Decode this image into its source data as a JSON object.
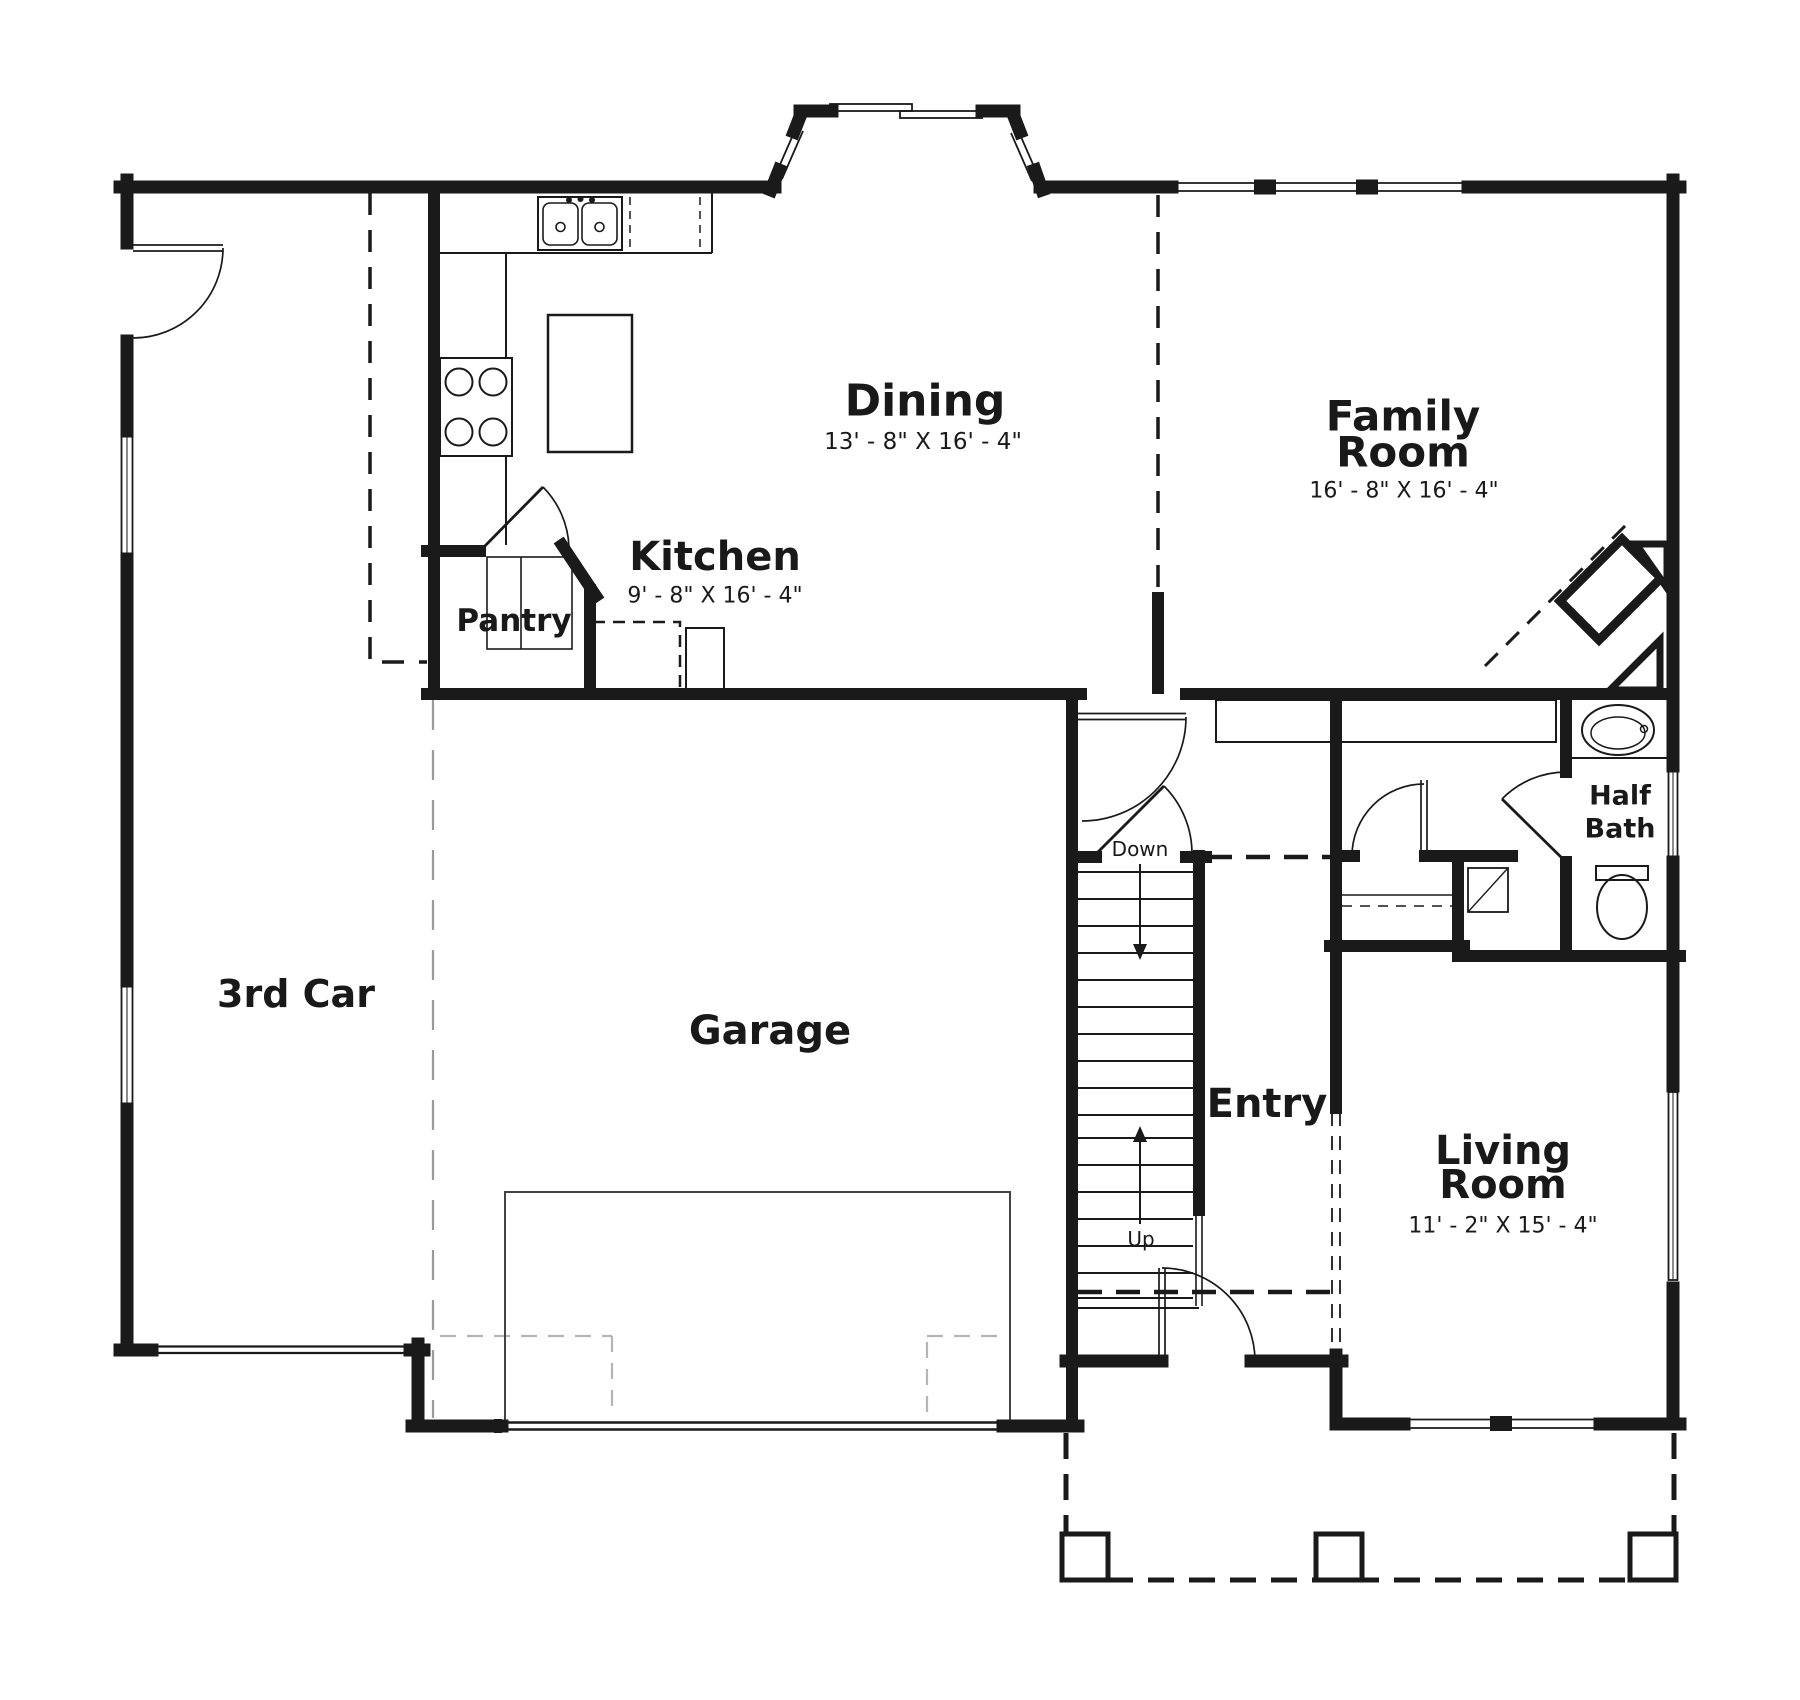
{
  "page": {
    "background": "#ffffff",
    "ink": "#1a1a1a",
    "gray_dash": "#b5b5b5"
  },
  "rooms": [
    {
      "id": "dining",
      "name": "Dining",
      "dims": "13' - 8\" X 16' - 4\""
    },
    {
      "id": "family-room",
      "name": "Family",
      "name_line2": "Room",
      "dims": "16' - 8\" X 16' - 4\""
    },
    {
      "id": "kitchen",
      "name": "Kitchen",
      "dims": "9' - 8\" X 16' - 4\""
    },
    {
      "id": "pantry",
      "name": "Pantry"
    },
    {
      "id": "half-bath",
      "name": "Half",
      "name_line2": "Bath"
    },
    {
      "id": "third-car",
      "name": "3rd Car"
    },
    {
      "id": "garage",
      "name": "Garage"
    },
    {
      "id": "entry",
      "name": "Entry"
    },
    {
      "id": "living-room",
      "name": "Living",
      "name_line2": "Room",
      "dims": "11' - 2\" X 15' - 4\""
    }
  ],
  "stairs": {
    "down_label": "Down",
    "up_label": "Up"
  }
}
